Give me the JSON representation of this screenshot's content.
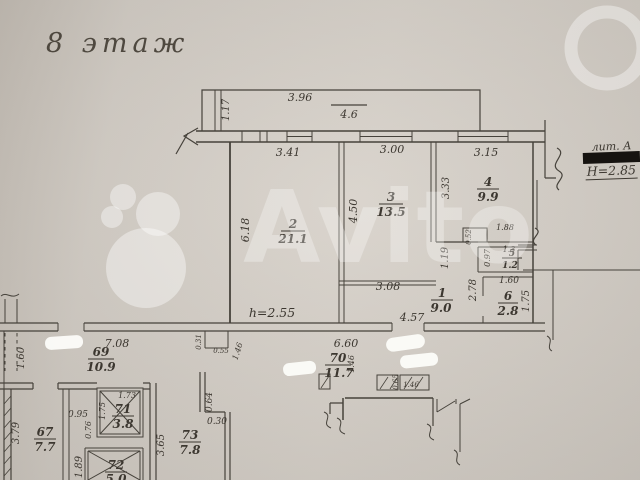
{
  "title": "8 этаж",
  "watermark": {
    "text": "Avito"
  },
  "notes": {
    "ceiling_height": "h=2.55",
    "liter": "лит. А",
    "building_height": "Н=2.85"
  },
  "rooms": [
    {
      "number": "2",
      "area": "21.1"
    },
    {
      "number": "3",
      "area": "13.5"
    },
    {
      "number": "4",
      "area": "9.9"
    },
    {
      "number": "5",
      "area": "1.2"
    },
    {
      "number": "6",
      "area": "2.8"
    },
    {
      "number": "1",
      "area": "9.0"
    },
    {
      "number": "69",
      "area": "10.9"
    },
    {
      "number": "70",
      "area": "11.7"
    },
    {
      "number": "67",
      "area": "7.7"
    },
    {
      "number": "71",
      "area": "3.8"
    },
    {
      "number": "72",
      "area": "5.0"
    },
    {
      "number": "73",
      "area": "7.8"
    }
  ],
  "dims": [
    "1.17",
    "3.96",
    "4.6",
    "3.41",
    "3.00",
    "3.15",
    "6.18",
    "4.50",
    "3.33",
    "1.19",
    "1.88",
    "0.52",
    "0.97",
    "1.3",
    "2.78",
    "1.60",
    "1.75",
    "3.08",
    "4.57",
    "7.08",
    "6.60",
    "1.60",
    "3.79",
    "0.95",
    "0.76",
    "1.73",
    "1.75",
    "1.89",
    "3.65",
    "0.64",
    "0.30",
    "0.31",
    "0.55",
    "1.46",
    "1.46",
    "0.65",
    "1.46"
  ]
}
